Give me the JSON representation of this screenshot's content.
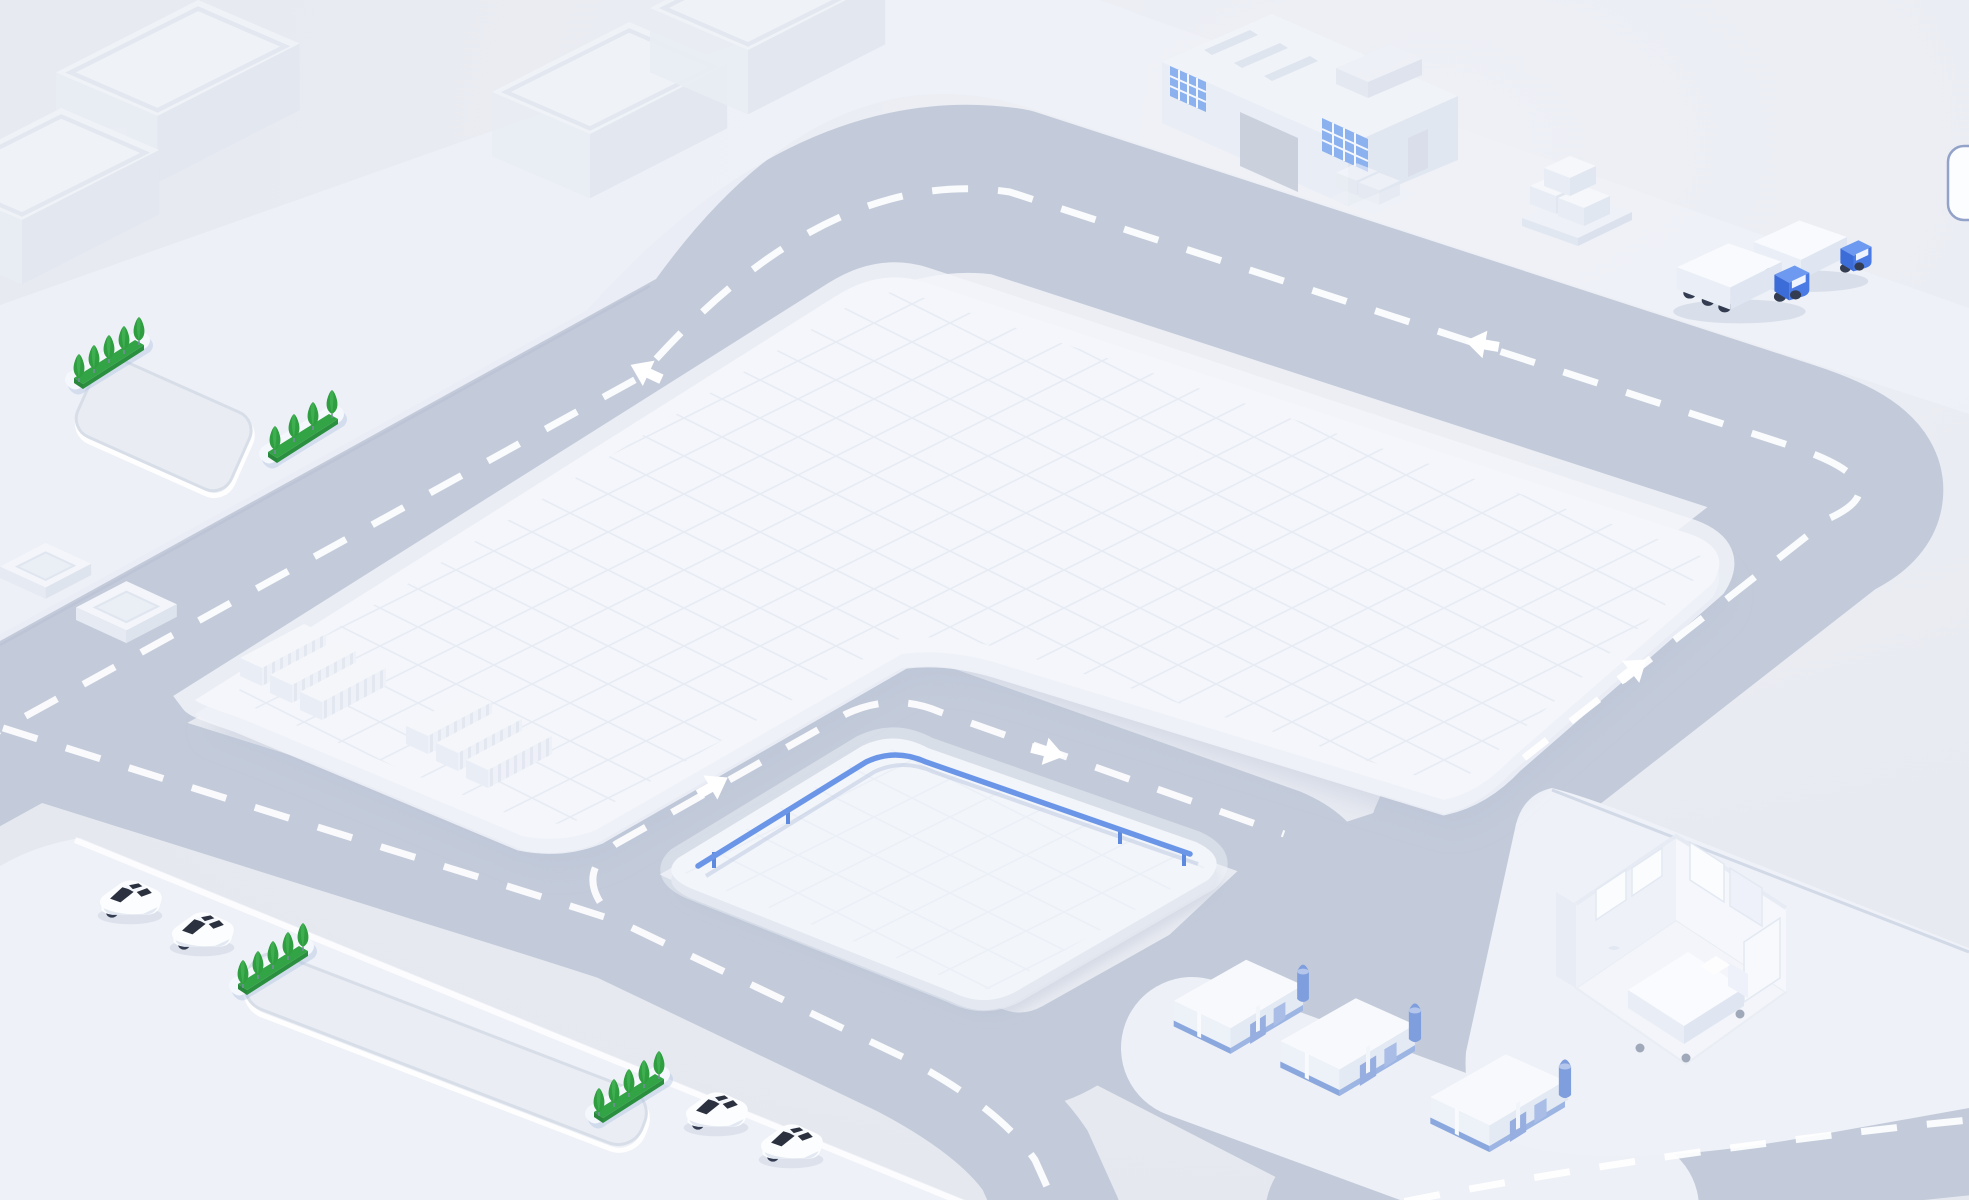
{
  "meta": {
    "title": "Isometric smart logistics park illustration",
    "canvas": {
      "width": 1969,
      "height": 1200
    },
    "text_content": "none - purely pictorial scene"
  },
  "palette": {
    "background": "#e8eaf1",
    "background_light": "#eef0f6",
    "road": "#c3cbda",
    "road_marking": "#ffffff",
    "sidewalk_pad": "#eef1f7",
    "plaza": "#f4f6fb",
    "plaza_grid": "#e4e9f2",
    "plaza_side": "#d8deea",
    "recess": "#e9edf3",
    "railing_blue": "#6b96e8",
    "truck_cab_blue": "#4a7ae4",
    "warehouse_accent_blue": "#8ba8de",
    "window_blue": "#7fa9ee",
    "hedge_green": "#33a445",
    "tree_green": "#2f9e40",
    "car_glass": "#2b313f",
    "wheel_dark": "#333c50",
    "shadow_soft": "#c2cbdd",
    "pill_border": "#93a2c9",
    "pill_fill": "#fcfdff"
  },
  "scene": {
    "plaza": {
      "label": "central plaza with grid paving"
    },
    "railing_pad": {
      "label": "inner pad with blue guardrail",
      "railing_color": "#6b96e8"
    },
    "pads": {
      "top_left_label": "upper sidewalk band with hedges and recessed bay",
      "bottom_left_label": "lower parking pad with cars and recessed lane",
      "warehouse_label": "warehouse pad",
      "right_label": "pad with hospital room cutaway"
    },
    "factory": {
      "label": "factory building with skylights and blue windows"
    },
    "room": {
      "label": "hospital room cutaway with bed and cabinets"
    },
    "pallets": {
      "label": "pallet stacks with boxes"
    },
    "scroll_pill": {
      "label": "partially visible rounded control at right edge"
    },
    "roads": {
      "label": "gray ring road network with white dashed centerlines",
      "dash_pattern": "36 30"
    },
    "arrows": {
      "label": "traffic direction arrows",
      "items": [
        {
          "id": "arrow-main-west",
          "transform": "translate(646,372) rotate(25)"
        },
        {
          "id": "arrow-top-west",
          "transform": "translate(1482,344) rotate(10)"
        },
        {
          "id": "arrow-right-up",
          "transform": "translate(1633,670) rotate(142)"
        },
        {
          "id": "arrow-inner-up",
          "transform": "translate(713,786) rotate(150)"
        },
        {
          "id": "arrow-inner-right",
          "transform": "translate(1048,752) rotate(194)"
        }
      ]
    },
    "slabs": {
      "label": "ghosted long warehouse slabs",
      "items": [
        {
          "transform": "translate(56,0) scale(1.45)"
        },
        {
          "transform": "translate(492,22) scale(1.4)"
        },
        {
          "transform": "translate(650,-62) scale(1.4)"
        },
        {
          "transform": "translate(-76,108) scale(1.4)"
        }
      ]
    },
    "containers": {
      "label": "white container stacks on plaza corner",
      "items": [
        {
          "transform": "translate(232,618)"
        },
        {
          "transform": "translate(398,686)"
        }
      ]
    },
    "hedges": {
      "label": "green hedge strips with trees",
      "items": [
        {
          "type": "hedge5",
          "transform": "translate(64,318)"
        },
        {
          "type": "hedge4",
          "transform": "translate(258,392)"
        },
        {
          "type": "hedge5",
          "transform": "translate(228,924)"
        },
        {
          "type": "hedge5",
          "transform": "translate(584,1052)"
        }
      ]
    },
    "cars": {
      "label": "white sedans",
      "items": [
        {
          "transform": "translate(92,872) scale(0.95)"
        },
        {
          "transform": "translate(164,904) scale(0.95)"
        },
        {
          "transform": "translate(678,1084) scale(0.95)"
        },
        {
          "transform": "translate(753,1116) scale(0.95)"
        }
      ]
    },
    "trucks": {
      "label": "delivery trucks with blue cabs",
      "items": [
        {
          "transform": "translate(1664,236) scale(0.92)"
        },
        {
          "transform": "translate(1742,214) scale(0.82)"
        }
      ]
    },
    "warehouses": {
      "label": "small warehouses with blue doors",
      "items": [
        {
          "transform": "translate(1158,948) scale(0.98)"
        },
        {
          "transform": "translate(1264,986) scale(1.02)"
        },
        {
          "transform": "translate(1414,1042) scale(1.02)"
        }
      ]
    },
    "platforms": {
      "label": "stepped loading platforms",
      "items": [
        {
          "transform": "translate(0,540) scale(0.95)"
        },
        {
          "transform": "translate(76,578) scale(1.05)"
        }
      ]
    }
  }
}
